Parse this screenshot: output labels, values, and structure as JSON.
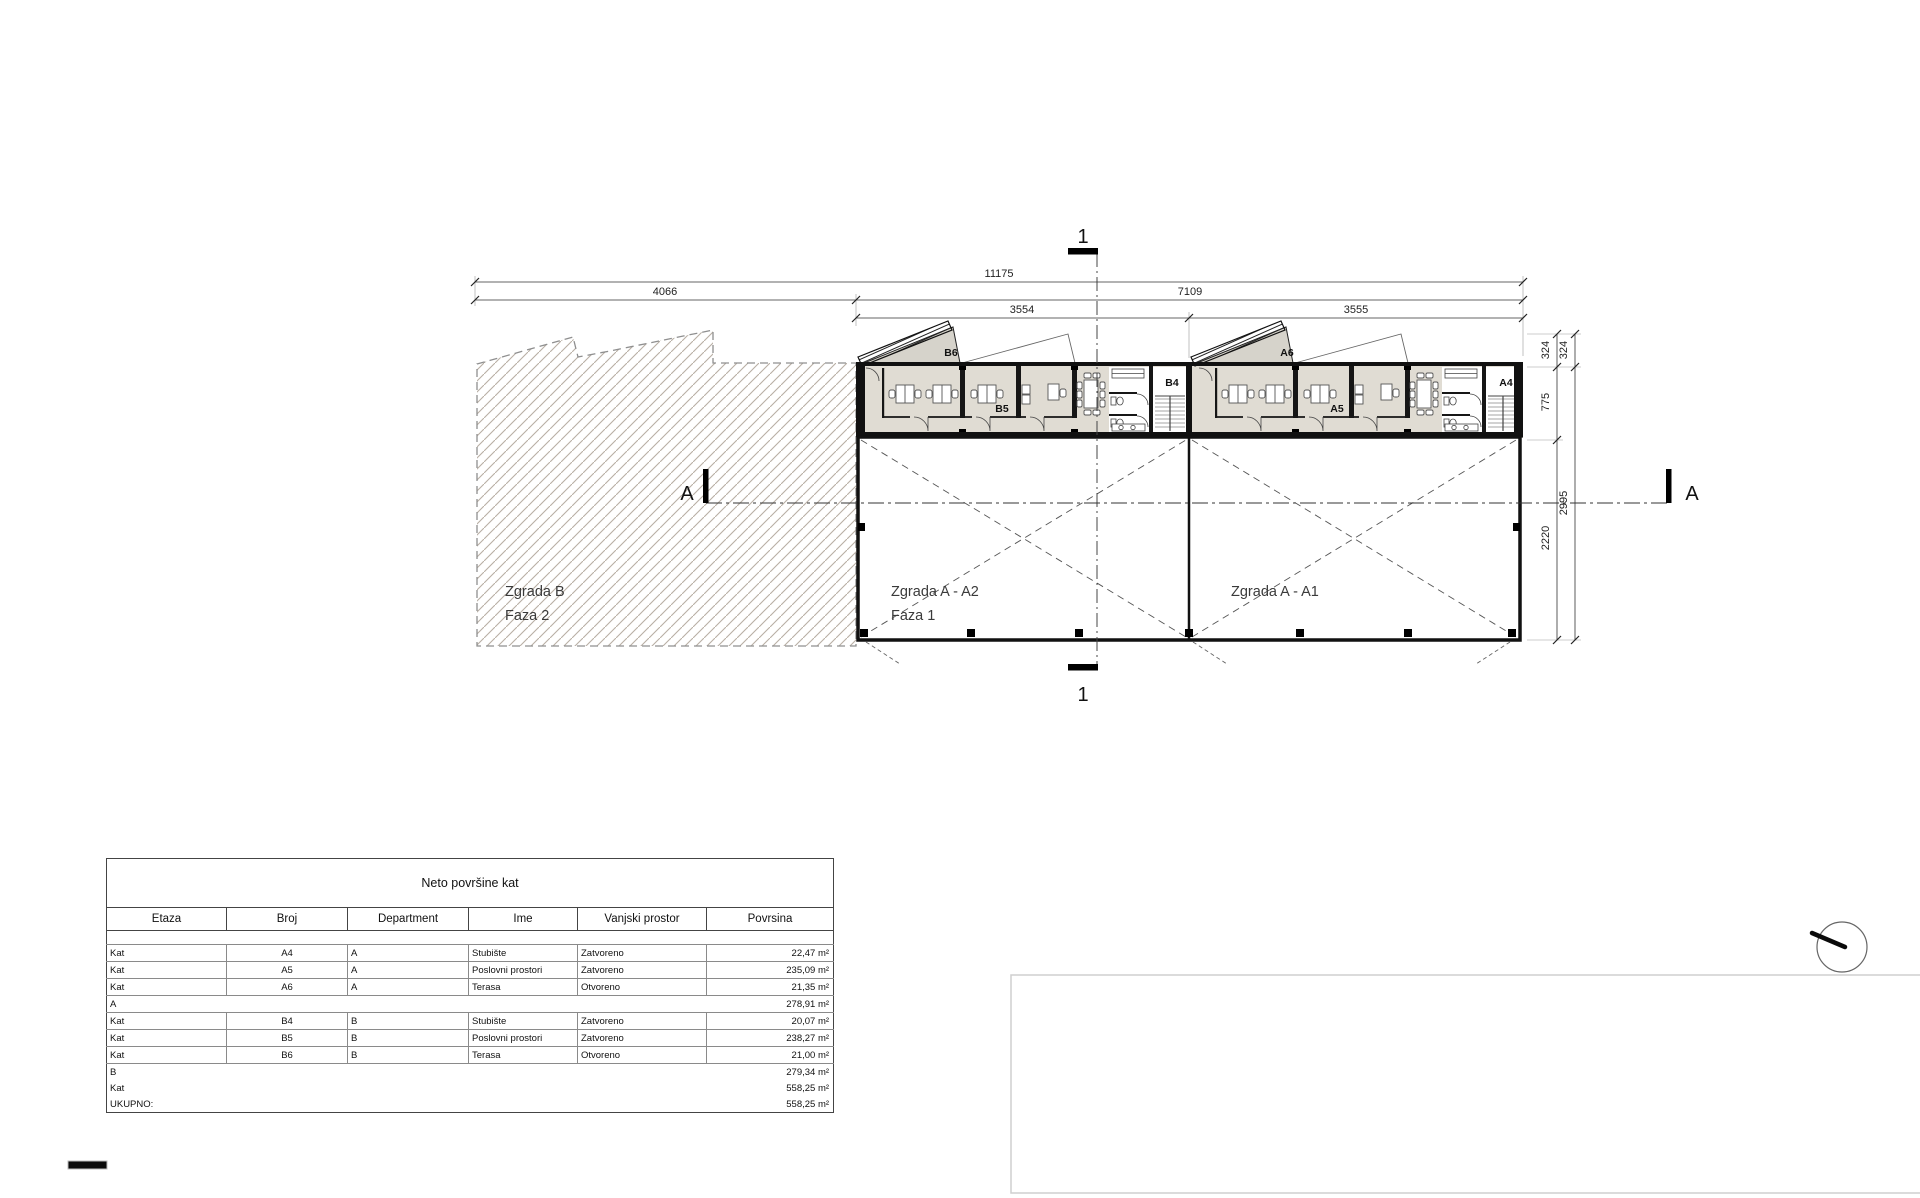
{
  "drawing": {
    "section1_top": "1",
    "section1_bottom": "1",
    "sectionA_left": "A",
    "sectionA_right": "A",
    "dims": {
      "total": "11175",
      "left": "4066",
      "right": "7109",
      "bay_b": "3554",
      "bay_a": "3555",
      "v324_inner": "324",
      "v324_outer": "324",
      "v775": "775",
      "v2220": "2220",
      "v2995": "2995"
    },
    "labels": {
      "zgrada_b": "Zgrada B",
      "faza2": "Faza 2",
      "zgrada_a2": "Zgrada A - A2",
      "faza1": "Faza 1",
      "zgrada_a1": "Zgrada A - A1"
    },
    "rooms": {
      "b6": "B6",
      "b5": "B5",
      "b4": "B4",
      "a6": "A6",
      "a5": "A5",
      "a4": "A4"
    }
  },
  "table": {
    "title": "Neto površine kat",
    "columns": [
      "Etaza",
      "Broj",
      "Department",
      "Ime",
      "Vanjski prostor",
      "Povrsina"
    ],
    "rows": [
      {
        "etaza": "Kat",
        "broj": "A4",
        "department": "A",
        "ime": "Stubište",
        "vanjski": "Zatvoreno",
        "povrsina": "22,47 m²"
      },
      {
        "etaza": "Kat",
        "broj": "A5",
        "department": "A",
        "ime": "Poslovni prostori",
        "vanjski": "Zatvoreno",
        "povrsina": "235,09 m²"
      },
      {
        "etaza": "Kat",
        "broj": "A6",
        "department": "A",
        "ime": "Terasa",
        "vanjski": "Otvoreno",
        "povrsina": "21,35 m²"
      },
      {
        "etaza": "A",
        "povrsina": "278,91 m²"
      },
      {
        "etaza": "Kat",
        "broj": "B4",
        "department": "B",
        "ime": "Stubište",
        "vanjski": "Zatvoreno",
        "povrsina": "20,07 m²"
      },
      {
        "etaza": "Kat",
        "broj": "B5",
        "department": "B",
        "ime": "Poslovni prostori",
        "vanjski": "Zatvoreno",
        "povrsina": "238,27 m²"
      },
      {
        "etaza": "Kat",
        "broj": "B6",
        "department": "B",
        "ime": "Terasa",
        "vanjski": "Otvoreno",
        "povrsina": "21,00 m²"
      },
      {
        "etaza": "B",
        "povrsina": "279,34 m²"
      },
      {
        "etaza": "Kat",
        "povrsina": "558,25 m²"
      },
      {
        "etaza": "UKUPNO:",
        "povrsina": "558,25 m²"
      }
    ]
  }
}
